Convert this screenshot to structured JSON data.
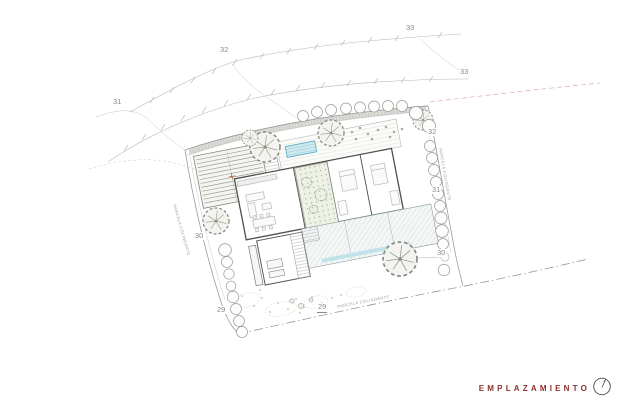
{
  "title_block": {
    "title": "EMPLAZAMIENTO",
    "accent_color": "#8e302e"
  },
  "elevation_labels": [
    {
      "text": "31",
      "location": "upper-contour-left"
    },
    {
      "text": "32",
      "location": "upper-contour"
    },
    {
      "text": "33",
      "location": "upper-contour-right"
    },
    {
      "text": "33",
      "location": "second-contour-right-end"
    },
    {
      "text": "32",
      "location": "parcel-right-edge"
    },
    {
      "text": "31",
      "location": "parcel-right-edge"
    },
    {
      "text": "30",
      "location": "parcel-right-edge"
    },
    {
      "text": "30",
      "location": "parcel-left-edge"
    },
    {
      "text": "29",
      "location": "parcel-left-edge"
    },
    {
      "text": "29",
      "location": "parcel-bottom-edge",
      "underlined": true
    }
  ],
  "boundary_labels": {
    "left": {
      "text": "PARCELA COLINDANTE"
    },
    "right": {
      "text": "PARCELA COLINDANTE"
    },
    "bottom": {
      "text": "PARCELA COLINDANTE"
    }
  },
  "colors": {
    "accent": "#8e302e",
    "pool_fill": "#cfe9ef",
    "pool_stroke": "#5fb0c6",
    "contour_line": "#b8b8b8",
    "boundary_line": "#9c9c9c",
    "wall_line": "#4f4f4f",
    "vegetation": "#878c82"
  }
}
